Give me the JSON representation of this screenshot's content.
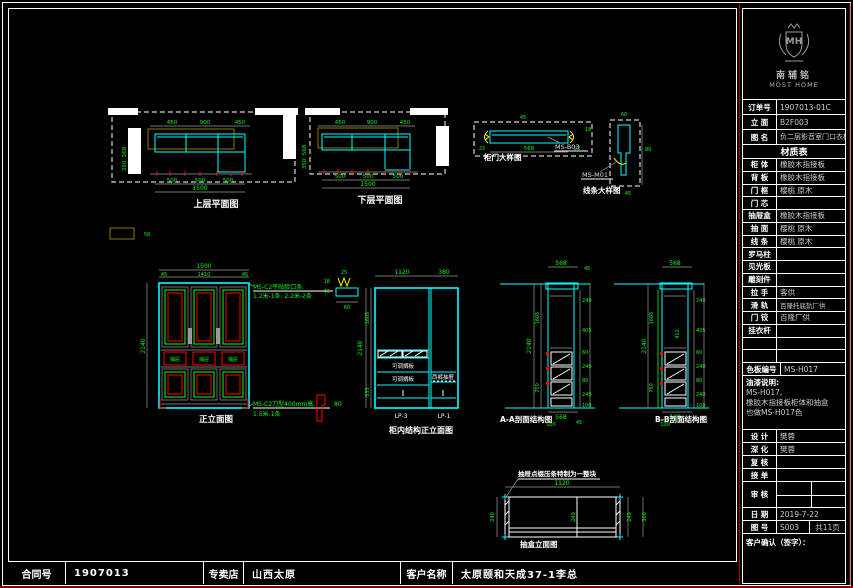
{
  "colors": {
    "background": "#000000",
    "line_white": "#ffffff",
    "cad_cyan": "#00ffff",
    "cad_green": "#00ff00",
    "cad_red": "#ff0000",
    "cad_yellow": "#ffff00",
    "cad_gray": "#9a9a9a",
    "cad_olive": "#8a7a00",
    "accent_darkred": "#8b0000"
  },
  "views": {
    "plan_upper": {
      "title": "上层平面图",
      "dims_top": [
        "450",
        "900",
        "450"
      ],
      "dims_bottom": [
        "500",
        "500",
        "500"
      ],
      "dim_overall": "1500",
      "dims_left": [
        "568",
        "350"
      ],
      "note_dim": "50"
    },
    "plan_lower": {
      "title": "下层平面图",
      "dims_top": [
        "450",
        "900",
        "450"
      ],
      "dims_bottom": [
        "500",
        "500",
        "500"
      ],
      "dim_overall": "1500",
      "dims_left": [
        "568",
        "350"
      ]
    },
    "door_detail": {
      "title": "柜门大样图",
      "code": "MS-B03",
      "dim_width": "568",
      "dim_side_l": "22",
      "dim_side_r": "22",
      "dim_top": "45",
      "dim_right": "18"
    },
    "trim_detail": {
      "title": "线条大样图",
      "code": "MS-M01",
      "dim_top": "60",
      "dim_right": "80",
      "dim_bottom": "45"
    },
    "bracket_detail": {
      "dim_a": "25",
      "dim_b": "18",
      "dim_c": "40",
      "dim_d": "60"
    },
    "profile_detail": {
      "dim": "80"
    },
    "front": {
      "title": "正立面图",
      "dim_width": "1500",
      "dims_sub": [
        "45",
        "1410",
        "45"
      ],
      "dim_height": "2140",
      "drawer_label": "抽屉",
      "note1_line1": "MS-C2平贴脸口条.",
      "note1_line2": "1.2米-1条, 2.2米-2条",
      "note2_line1": "MS-C2刀型400mm高.",
      "note2_line2": "1.5米-1条"
    },
    "inner": {
      "title": "柜内结构正立面图",
      "dim_top_left": "1120",
      "dim_top_right": "380",
      "dim_height": "2140",
      "dims_left": [
        "1605",
        "535"
      ],
      "shelf_label": "可调搁板",
      "right_label": "西裤抽屉",
      "unit_left": "LP-3",
      "unit_right": "LP-1"
    },
    "section_a": {
      "title": "A-A剖面结构图",
      "dim_top": "568",
      "dim_top_side": "45",
      "dim_height": "2140",
      "dims_left": [
        "1605",
        "750"
      ],
      "dims_right": [
        "240",
        "405",
        "60",
        "240",
        "80",
        "240",
        "100"
      ],
      "dims_bottom": [
        "568",
        "100",
        "45"
      ]
    },
    "section_b": {
      "title": "B-B剖面结构图",
      "dim_top": "568",
      "dim_height": "2140",
      "dims_left": [
        "1605",
        "750"
      ],
      "dims_right": [
        "240",
        "405",
        "60",
        "240",
        "80",
        "240",
        "100"
      ],
      "dims_bottom": [
        "568",
        "100"
      ],
      "inner_dim": "412"
    },
    "drawer_box": {
      "title": "抽盒立面图",
      "note": "抽屉点缀压条特制为一整块",
      "dim_top": "1120",
      "dim_left": "240",
      "dim_mid": "240",
      "dims_right": [
        "240",
        "300"
      ]
    }
  },
  "titleblock": {
    "logo_monogram": "MH",
    "brand_cn": "南辅铭",
    "brand_en": "MOST HOME",
    "fields": [
      {
        "label": "订单号",
        "value": "1907013-01C"
      },
      {
        "label": "立 面",
        "value": "B2F003"
      },
      {
        "label": "图 名",
        "value": "负二层影音室门口衣柜"
      }
    ],
    "materials_title": "材质表",
    "materials": [
      {
        "label": "柜 体",
        "value": "橡胶木指接板"
      },
      {
        "label": "背 板",
        "value": "橡胶木指接板"
      },
      {
        "label": "门 框",
        "value": "樱桃 原木"
      },
      {
        "label": "门 芯",
        "value": ""
      },
      {
        "label": "抽屉盒",
        "value": "橡胶木指接板"
      },
      {
        "label": "抽 面",
        "value": "樱桃 原木"
      },
      {
        "label": "线 条",
        "value": "樱桃 原木"
      },
      {
        "label": "罗马柱",
        "value": ""
      },
      {
        "label": "见光板",
        "value": ""
      },
      {
        "label": "雕刻件",
        "value": ""
      },
      {
        "label": "拉 手",
        "value": "客供"
      },
      {
        "label": "滑 轨",
        "value": "百隆托底轨厂供"
      },
      {
        "label": "门 铰",
        "value": "百隆厂供"
      },
      {
        "label": "挂衣杆",
        "value": ""
      },
      {
        "label": "",
        "value": ""
      },
      {
        "label": "",
        "value": ""
      }
    ],
    "color_code": {
      "label": "色板编号",
      "value": "MS-H017"
    },
    "paint_note": {
      "line1": "油漆说明:",
      "line2": "MS-H017,",
      "line3": "橡胶木指接板柜体和抽盒",
      "line4": "也做MS-H017色"
    },
    "sign_rows": [
      {
        "label": "设 计",
        "value": "樊蓉"
      },
      {
        "label": "深 化",
        "value": "樊蓉"
      },
      {
        "label": "复 核",
        "value": ""
      },
      {
        "label": "接 单",
        "value": ""
      }
    ],
    "audit_label": "审 核",
    "date": {
      "label": "日 期",
      "value": "2019-7-22"
    },
    "sheet": {
      "label": "图 号",
      "value": "S003",
      "pages": "共11页"
    },
    "confirm_label": "客户确认（签字）："
  },
  "bottombar": {
    "contract_label": "合同号",
    "contract_value": "1907013",
    "store_label": "专卖店",
    "store_value": "山西太原",
    "customer_label": "客户名称",
    "customer_value": "太原颐和天成37-1李总"
  }
}
